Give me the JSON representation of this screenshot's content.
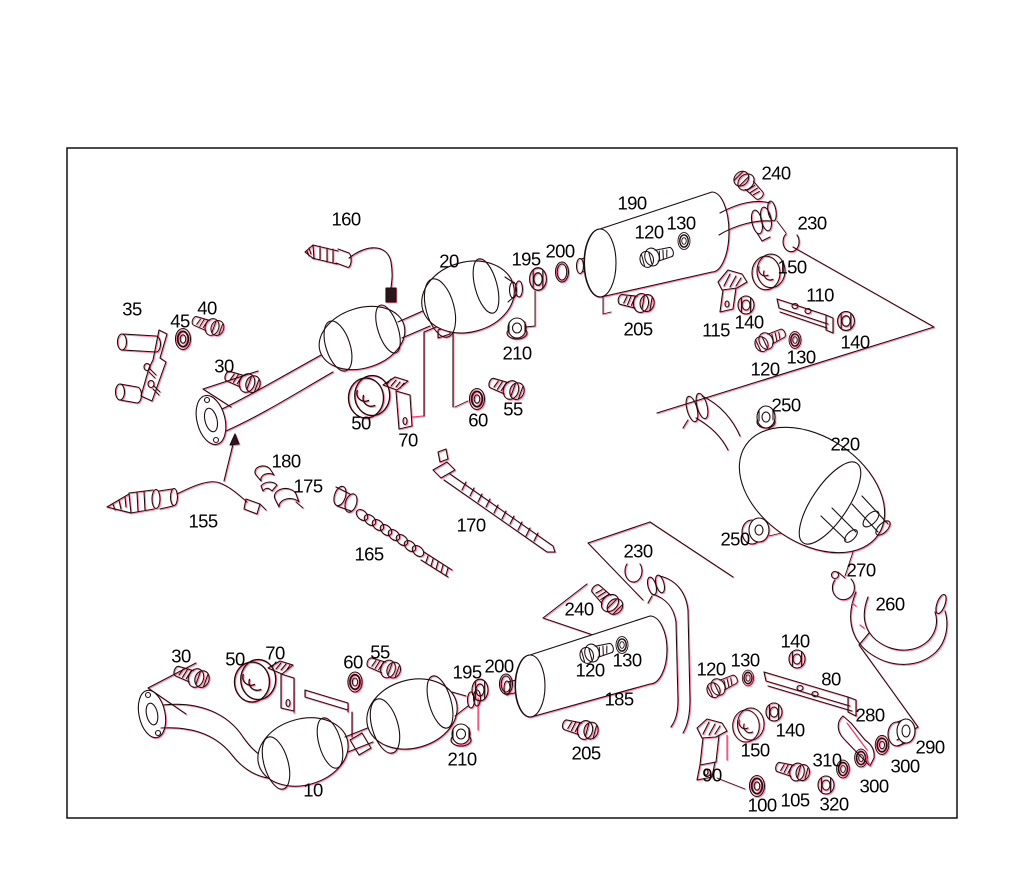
{
  "figure": {
    "type": "exploded-parts-diagram",
    "subject": "exhaust-system",
    "background": "#ffffff",
    "line_color": "#1c0a10",
    "fringe_color": "#ff5f86",
    "leader_color": "#e23d68",
    "label_color": "#000000",
    "border": {
      "x": 67,
      "y": 148,
      "width": 890,
      "height": 670
    }
  },
  "callouts": [
    {
      "label": "160",
      "x": 346,
      "y": 219
    },
    {
      "label": "190",
      "x": 632,
      "y": 203
    },
    {
      "label": "240",
      "x": 776,
      "y": 173
    },
    {
      "label": "230",
      "x": 812,
      "y": 223
    },
    {
      "label": "130",
      "x": 681,
      "y": 223
    },
    {
      "label": "120",
      "x": 649,
      "y": 232
    },
    {
      "label": "20",
      "x": 449,
      "y": 261
    },
    {
      "label": "195",
      "x": 526,
      "y": 259
    },
    {
      "label": "200",
      "x": 560,
      "y": 251
    },
    {
      "label": "150",
      "x": 792,
      "y": 267
    },
    {
      "label": "110",
      "x": 820,
      "y": 295
    },
    {
      "label": "35",
      "x": 132,
      "y": 309
    },
    {
      "label": "40",
      "x": 207,
      "y": 308
    },
    {
      "label": "45",
      "x": 180,
      "y": 321
    },
    {
      "label": "115",
      "x": 716,
      "y": 330
    },
    {
      "label": "140",
      "x": 749,
      "y": 322
    },
    {
      "label": "140",
      "x": 855,
      "y": 342
    },
    {
      "label": "205",
      "x": 638,
      "y": 329
    },
    {
      "label": "210",
      "x": 517,
      "y": 353
    },
    {
      "label": "130",
      "x": 801,
      "y": 357
    },
    {
      "label": "120",
      "x": 765,
      "y": 369
    },
    {
      "label": "30",
      "x": 224,
      "y": 366
    },
    {
      "label": "250",
      "x": 786,
      "y": 405
    },
    {
      "label": "50",
      "x": 361,
      "y": 423
    },
    {
      "label": "70",
      "x": 408,
      "y": 440
    },
    {
      "label": "60",
      "x": 478,
      "y": 420
    },
    {
      "label": "55",
      "x": 513,
      "y": 409
    },
    {
      "label": "220",
      "x": 845,
      "y": 444
    },
    {
      "label": "180",
      "x": 286,
      "y": 461
    },
    {
      "label": "175",
      "x": 308,
      "y": 486
    },
    {
      "label": "155",
      "x": 203,
      "y": 521
    },
    {
      "label": "170",
      "x": 471,
      "y": 525
    },
    {
      "label": "230",
      "x": 638,
      "y": 551
    },
    {
      "label": "165",
      "x": 369,
      "y": 554
    },
    {
      "label": "250",
      "x": 735,
      "y": 539
    },
    {
      "label": "270",
      "x": 861,
      "y": 570
    },
    {
      "label": "240",
      "x": 579,
      "y": 609
    },
    {
      "label": "260",
      "x": 890,
      "y": 604
    },
    {
      "label": "30",
      "x": 181,
      "y": 656
    },
    {
      "label": "50",
      "x": 235,
      "y": 659
    },
    {
      "label": "70",
      "x": 275,
      "y": 653
    },
    {
      "label": "60",
      "x": 353,
      "y": 662
    },
    {
      "label": "55",
      "x": 380,
      "y": 652
    },
    {
      "label": "195",
      "x": 467,
      "y": 672
    },
    {
      "label": "200",
      "x": 499,
      "y": 666
    },
    {
      "label": "120",
      "x": 590,
      "y": 670
    },
    {
      "label": "130",
      "x": 627,
      "y": 660
    },
    {
      "label": "185",
      "x": 619,
      "y": 699
    },
    {
      "label": "120",
      "x": 711,
      "y": 669
    },
    {
      "label": "130",
      "x": 745,
      "y": 660
    },
    {
      "label": "140",
      "x": 795,
      "y": 641
    },
    {
      "label": "80",
      "x": 831,
      "y": 679
    },
    {
      "label": "280",
      "x": 870,
      "y": 715
    },
    {
      "label": "140",
      "x": 790,
      "y": 730
    },
    {
      "label": "150",
      "x": 755,
      "y": 750
    },
    {
      "label": "310",
      "x": 827,
      "y": 760
    },
    {
      "label": "290",
      "x": 930,
      "y": 747
    },
    {
      "label": "300",
      "x": 905,
      "y": 766
    },
    {
      "label": "300",
      "x": 874,
      "y": 786
    },
    {
      "label": "90",
      "x": 712,
      "y": 775
    },
    {
      "label": "100",
      "x": 762,
      "y": 805
    },
    {
      "label": "105",
      "x": 795,
      "y": 800
    },
    {
      "label": "320",
      "x": 834,
      "y": 804
    },
    {
      "label": "210",
      "x": 462,
      "y": 759
    },
    {
      "label": "205",
      "x": 586,
      "y": 753
    },
    {
      "label": "10",
      "x": 313,
      "y": 790
    }
  ]
}
